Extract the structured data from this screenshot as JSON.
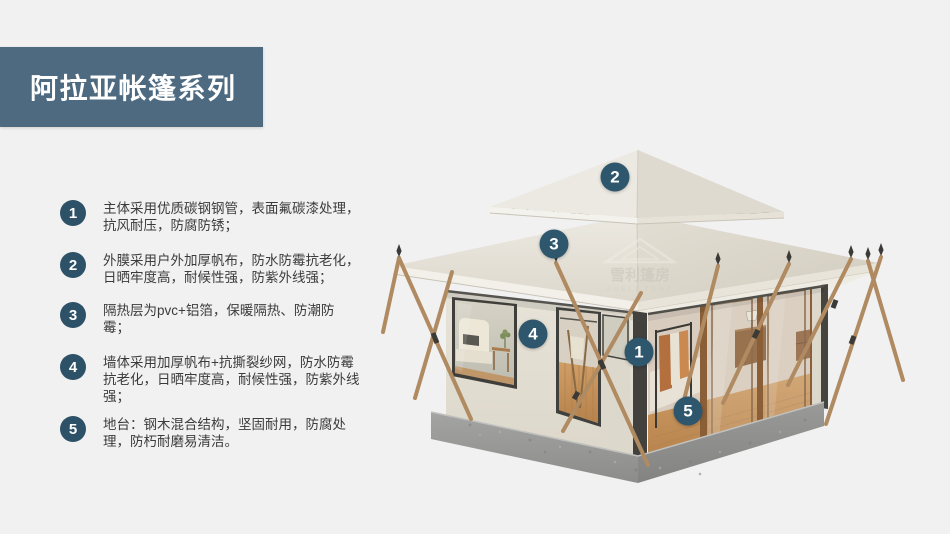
{
  "page": {
    "background_color": "#f1f1f2",
    "accent_color": "#4d6a81",
    "badge_color": "#2d5166",
    "marker_color": "#2e566d"
  },
  "header": {
    "title": "阿拉亚帐篷系列"
  },
  "features": [
    {
      "num": "1",
      "text": "主体采用优质碳钢钢管，表面氟碳漆处理，抗风耐压，防腐防锈；"
    },
    {
      "num": "2",
      "text": "外膜采用户外加厚帆布，防水防霉抗老化，日晒牢度高，耐候性强，防紫外线强；"
    },
    {
      "num": "3",
      "text": "隔热层为pvc+铝箔，保暖隔热、防潮防霉；"
    },
    {
      "num": "4",
      "text": "墙体采用加厚帆布+抗撕裂纱网，防水防霉抗老化，日晒牢度高，耐候性强，防紫外线强；"
    },
    {
      "num": "5",
      "text": "地台：钢木混合结构，坚固耐用，防腐处理，防朽耐磨易清洁。"
    }
  ],
  "tent_markers": [
    {
      "num": "1"
    },
    {
      "num": "2"
    },
    {
      "num": "3"
    },
    {
      "num": "4"
    },
    {
      "num": "5"
    }
  ],
  "watermark": {
    "name": "雪利篷房",
    "subtitle": "XUELI TENT"
  }
}
